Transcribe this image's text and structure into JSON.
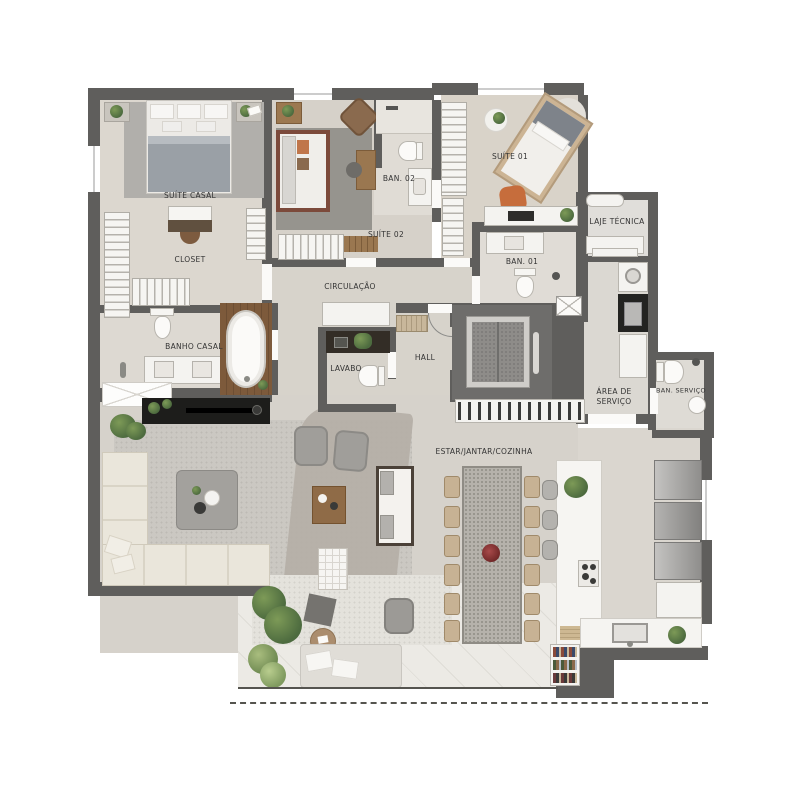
{
  "plan": {
    "type": "apartment-floor-plan",
    "rooms": {
      "suite_casal": "SUÍTE CASAL",
      "closet": "CLOSET",
      "suite_02": "SUÍTE 02",
      "ban_02": "BAN. 02",
      "suite_01": "SUÍTE 01",
      "ban_01": "BAN. 01",
      "laje_tecnica": "LAJE TÉCNICA",
      "circulacao": "CIRCULAÇÃO",
      "banho_casal": "BANHO CASAL",
      "lavabo": "LAVABO",
      "hall": "HALL",
      "area_servico_l1": "ÁREA DE",
      "area_servico_l2": "SERVIÇO",
      "ban_servico": "BAN. SERVIÇO",
      "estar_jantar_cozinha": "ESTAR/JANTAR/COZINHA"
    },
    "colors": {
      "wall": "#5f5e5c",
      "floor_warm": "#dcd7cf",
      "floor_beige": "#d6d2ca",
      "terrace": "#eceae5",
      "rug_dark_gray": "#96948e",
      "wood_deck": "#7d5a3b",
      "bed_frame_accent": "#7c4a3b",
      "chair_accent": "#c66d3c",
      "counter_dark": "#232321",
      "plant_green": "#4d6b3f",
      "label_text": "#343434"
    }
  }
}
